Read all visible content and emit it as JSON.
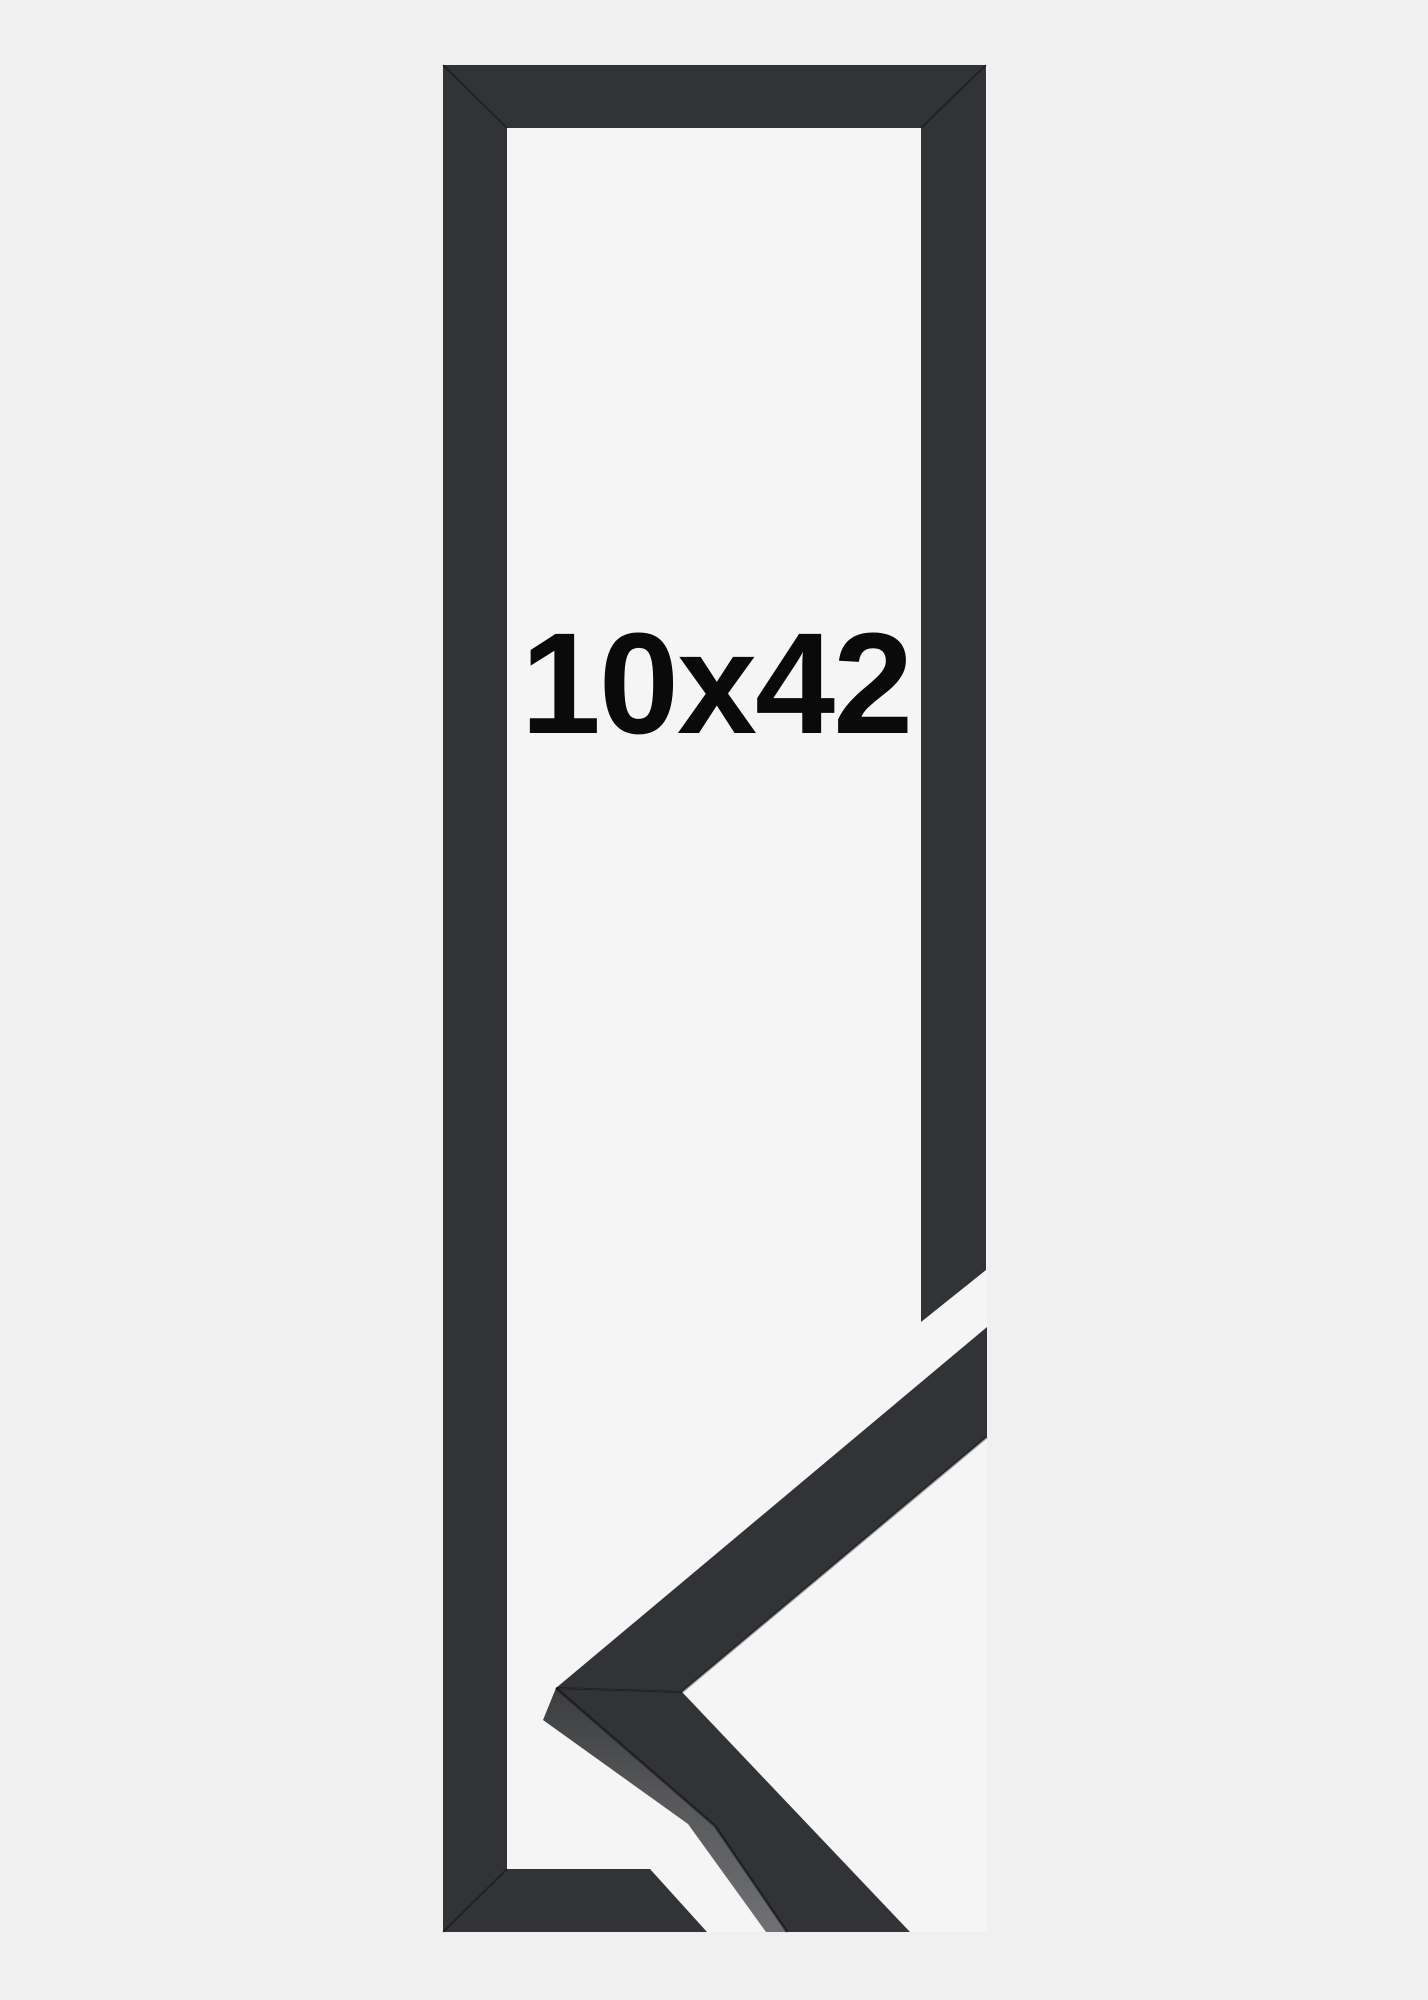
{
  "product_image": {
    "size_label": "10x42"
  },
  "colors": {
    "page_background": "#f0f0f1",
    "photo_background": "#f5f5f6",
    "frame": "#323336",
    "moulding_side_top": "#3c3d3f",
    "moulding_side_bottom": "#707174",
    "text": "#0a0a0b"
  }
}
